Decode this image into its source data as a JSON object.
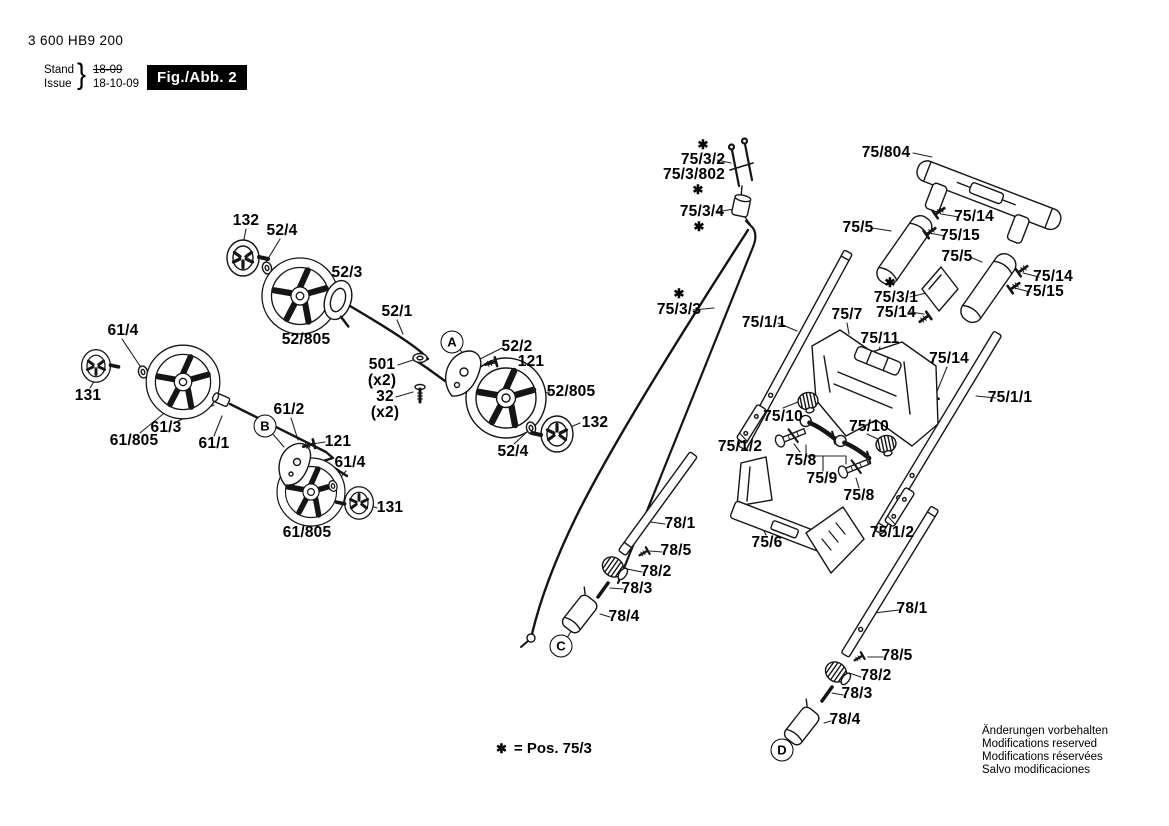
{
  "header": {
    "part_number": "3 600 HB9 200",
    "stand_label": "Stand",
    "issue_label": "Issue",
    "brace": "}",
    "stand_value": "18-09",
    "issue_value": "18-10-09",
    "figure_label": "Fig./Abb. 2"
  },
  "footnote": {
    "star": "✱",
    "text": "= Pos. 75/3"
  },
  "footer_lines": [
    "Änderungen vorbehalten",
    "Modifications reserved",
    "Modifications réservées",
    "Salvo modificaciones"
  ],
  "reference_points": [
    {
      "letter": "A",
      "x": 452,
      "y": 342
    },
    {
      "letter": "B",
      "x": 265,
      "y": 426
    },
    {
      "letter": "C",
      "x": 561,
      "y": 646
    },
    {
      "letter": "D",
      "x": 782,
      "y": 750
    }
  ],
  "part_labels": [
    {
      "text": "132",
      "x": 246,
      "y": 221
    },
    {
      "text": "52/4",
      "x": 282,
      "y": 231
    },
    {
      "text": "52/3",
      "x": 347,
      "y": 273
    },
    {
      "text": "52/1",
      "x": 397,
      "y": 312
    },
    {
      "text": "52/805",
      "x": 306,
      "y": 340
    },
    {
      "text": "61/4",
      "x": 123,
      "y": 331
    },
    {
      "text": "131",
      "x": 88,
      "y": 396
    },
    {
      "text": "61/3",
      "x": 166,
      "y": 428
    },
    {
      "text": "61/805",
      "x": 134,
      "y": 441
    },
    {
      "text": "61/1",
      "x": 214,
      "y": 444
    },
    {
      "text": "501",
      "x": 382,
      "y": 365
    },
    {
      "text": "(x2)",
      "x": 382,
      "y": 381
    },
    {
      "text": "32",
      "x": 385,
      "y": 397
    },
    {
      "text": "(x2)",
      "x": 385,
      "y": 413
    },
    {
      "text": "52/2",
      "x": 517,
      "y": 347
    },
    {
      "text": "121",
      "x": 531,
      "y": 362
    },
    {
      "text": "52/805",
      "x": 571,
      "y": 392
    },
    {
      "text": "132",
      "x": 595,
      "y": 423
    },
    {
      "text": "52/4",
      "x": 513,
      "y": 452
    },
    {
      "text": "61/2",
      "x": 289,
      "y": 410
    },
    {
      "text": "121",
      "x": 338,
      "y": 442
    },
    {
      "text": "61/4",
      "x": 350,
      "y": 463
    },
    {
      "text": "131",
      "x": 390,
      "y": 508
    },
    {
      "text": "61/805",
      "x": 307,
      "y": 533
    },
    {
      "text": "78/1",
      "x": 680,
      "y": 524
    },
    {
      "text": "78/5",
      "x": 676,
      "y": 551
    },
    {
      "text": "78/2",
      "x": 656,
      "y": 572
    },
    {
      "text": "78/3",
      "x": 637,
      "y": 589
    },
    {
      "text": "78/4",
      "x": 624,
      "y": 617
    },
    {
      "text": "✱",
      "x": 703,
      "y": 145,
      "star": true
    },
    {
      "text": "75/3/2",
      "x": 703,
      "y": 160
    },
    {
      "text": "75/3/802",
      "x": 694,
      "y": 175
    },
    {
      "text": "✱",
      "x": 698,
      "y": 190,
      "star": true
    },
    {
      "text": "75/3/4",
      "x": 702,
      "y": 212
    },
    {
      "text": "✱",
      "x": 699,
      "y": 227,
      "star": true
    },
    {
      "text": "✱",
      "x": 679,
      "y": 294,
      "star": true
    },
    {
      "text": "75/3/3",
      "x": 679,
      "y": 310
    },
    {
      "text": "75/804",
      "x": 886,
      "y": 153
    },
    {
      "text": "75/14",
      "x": 974,
      "y": 217
    },
    {
      "text": "75/15",
      "x": 960,
      "y": 236
    },
    {
      "text": "75/5",
      "x": 858,
      "y": 228
    },
    {
      "text": "75/5",
      "x": 957,
      "y": 257
    },
    {
      "text": "75/14",
      "x": 1053,
      "y": 277
    },
    {
      "text": "75/15",
      "x": 1044,
      "y": 292
    },
    {
      "text": "✱",
      "x": 890,
      "y": 283,
      "star": true
    },
    {
      "text": "75/3/1",
      "x": 896,
      "y": 298
    },
    {
      "text": "75/14",
      "x": 896,
      "y": 313
    },
    {
      "text": "75/1/1",
      "x": 764,
      "y": 323
    },
    {
      "text": "75/7",
      "x": 847,
      "y": 315
    },
    {
      "text": "75/11",
      "x": 880,
      "y": 339
    },
    {
      "text": "75/14",
      "x": 949,
      "y": 359
    },
    {
      "text": "75/1/1",
      "x": 1010,
      "y": 398
    },
    {
      "text": "75/10",
      "x": 783,
      "y": 417
    },
    {
      "text": "75/10",
      "x": 869,
      "y": 427
    },
    {
      "text": "75/1/2",
      "x": 740,
      "y": 447
    },
    {
      "text": "75/8",
      "x": 801,
      "y": 461
    },
    {
      "text": "75/9",
      "x": 822,
      "y": 479
    },
    {
      "text": "75/8",
      "x": 859,
      "y": 496
    },
    {
      "text": "75/6",
      "x": 767,
      "y": 543
    },
    {
      "text": "75/1/2",
      "x": 892,
      "y": 533
    },
    {
      "text": "78/1",
      "x": 912,
      "y": 609
    },
    {
      "text": "78/5",
      "x": 897,
      "y": 656
    },
    {
      "text": "78/2",
      "x": 876,
      "y": 676
    },
    {
      "text": "78/3",
      "x": 857,
      "y": 694
    },
    {
      "text": "78/4",
      "x": 845,
      "y": 720
    }
  ]
}
